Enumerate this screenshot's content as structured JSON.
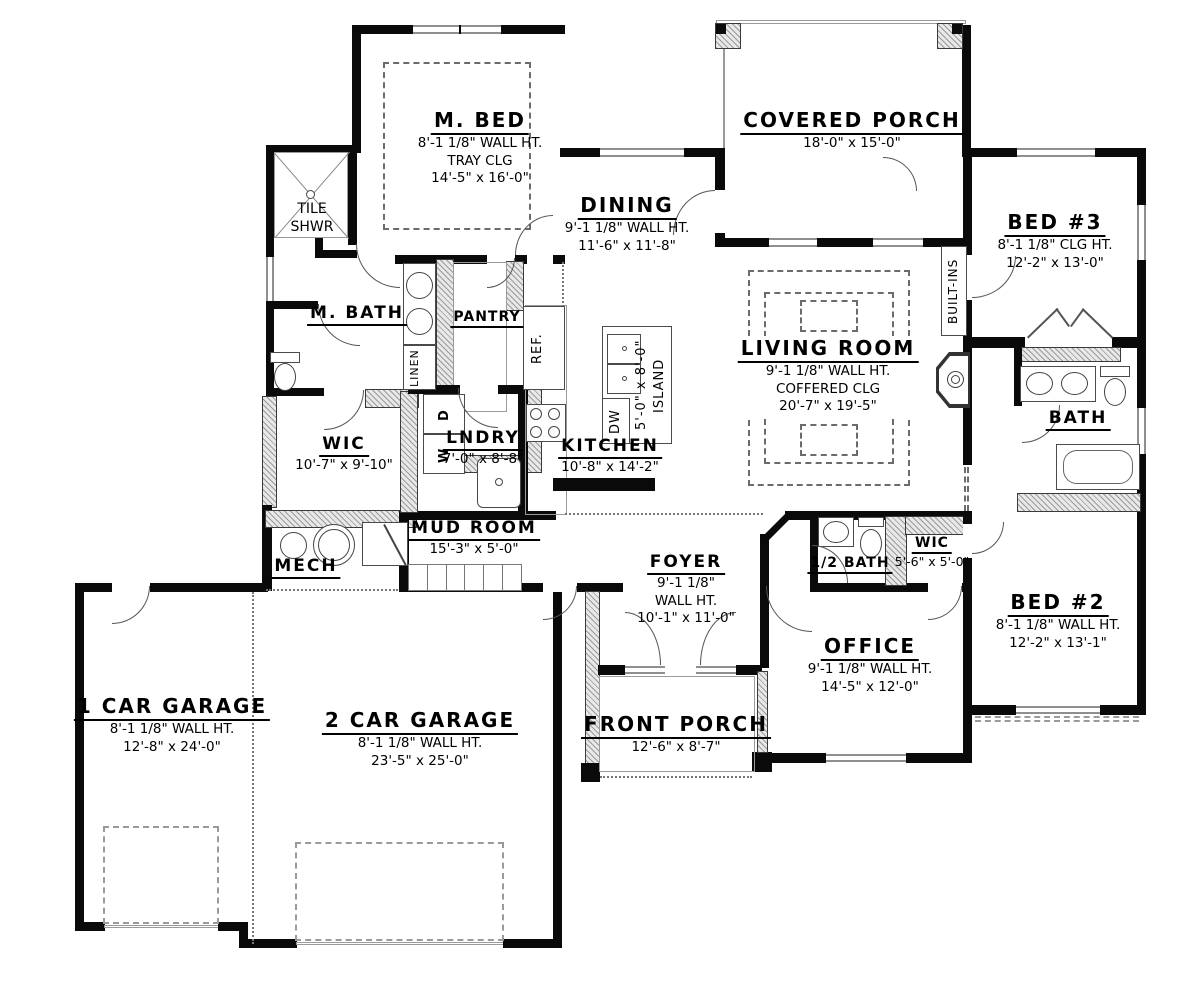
{
  "plan_title": "First floor plan",
  "colors": {
    "wall": "#0a0a0a",
    "window": "#8f8f8f",
    "hatch": "#9a9a9a",
    "dash": "#6b6b6b"
  },
  "rooms": {
    "m_bed": {
      "name": "M. BED",
      "dims": [
        "8'-1 1/8\" WALL HT.",
        "TRAY CLG",
        "14'-5\" x 16'-0\""
      ]
    },
    "tile_shwr": {
      "dims": [
        "TILE",
        "SHWR"
      ]
    },
    "m_bath": {
      "name": "M. BATH"
    },
    "linen": {
      "name": "LINEN"
    },
    "pantry": {
      "name": "PANTRY"
    },
    "ref": {
      "name": "REF."
    },
    "wic_master": {
      "name": "WIC",
      "dims": [
        "10'-7\" x 9'-10\""
      ]
    },
    "lndry": {
      "name": "LNDRY",
      "dims": [
        "7'-0\" x 8'-8\""
      ]
    },
    "washer": {
      "name": "W"
    },
    "dryer": {
      "name": "D"
    },
    "dishwasher": {
      "name": "DW"
    },
    "island": {
      "dims": [
        "5'-0\" x 8'-0\"",
        "ISLAND"
      ]
    },
    "kitchen": {
      "name": "KITCHEN",
      "dims": [
        "10'-8\" x 14'-2\""
      ]
    },
    "dining": {
      "name": "DINING",
      "dims": [
        "9'-1 1/8\" WALL HT.",
        "11'-6\" x 11'-8\""
      ]
    },
    "covered_porch": {
      "name": "COVERED PORCH",
      "dims": [
        "18'-0\" x 15'-0\""
      ]
    },
    "living": {
      "name": "LIVING ROOM",
      "dims": [
        "9'-1 1/8\" WALL HT.",
        "COFFERED CLG",
        "20'-7\" x 19'-5\""
      ]
    },
    "built_ins": {
      "name": "BUILT-INS"
    },
    "bed3": {
      "name": "BED #3",
      "dims": [
        "8'-1 1/8\" CLG HT.",
        "12'-2\" x 13'-0\""
      ]
    },
    "bath": {
      "name": "BATH"
    },
    "half_bath": {
      "name": "1/2 BATH"
    },
    "wic2": {
      "name": "WIC",
      "dims": [
        "5'-6\" x 5'-0\""
      ]
    },
    "office": {
      "name": "OFFICE",
      "dims": [
        "9'-1 1/8\" WALL HT.",
        "14'-5\" x 12'-0\""
      ]
    },
    "bed2": {
      "name": "BED #2",
      "dims": [
        "8'-1 1/8\" WALL HT.",
        "12'-2\" x 13'-1\""
      ]
    },
    "foyer": {
      "name": "FOYER",
      "dims": [
        "9'-1 1/8\"",
        "WALL HT.",
        "10'-1\" x 11'-0\""
      ]
    },
    "mud_room": {
      "name": "MUD ROOM",
      "dims": [
        "15'-3\" x 5'-0\""
      ]
    },
    "mech": {
      "name": "MECH"
    },
    "garage1": {
      "name": "1 CAR GARAGE",
      "dims": [
        "8'-1 1/8\" WALL HT.",
        "12'-8\" x 24'-0\""
      ]
    },
    "garage2": {
      "name": "2 CAR GARAGE",
      "dims": [
        "8'-1 1/8\" WALL HT.",
        "23'-5\" x 25'-0\""
      ]
    },
    "front_porch": {
      "name": "FRONT PORCH",
      "dims": [
        "12'-6\" x 8'-7\""
      ]
    }
  }
}
